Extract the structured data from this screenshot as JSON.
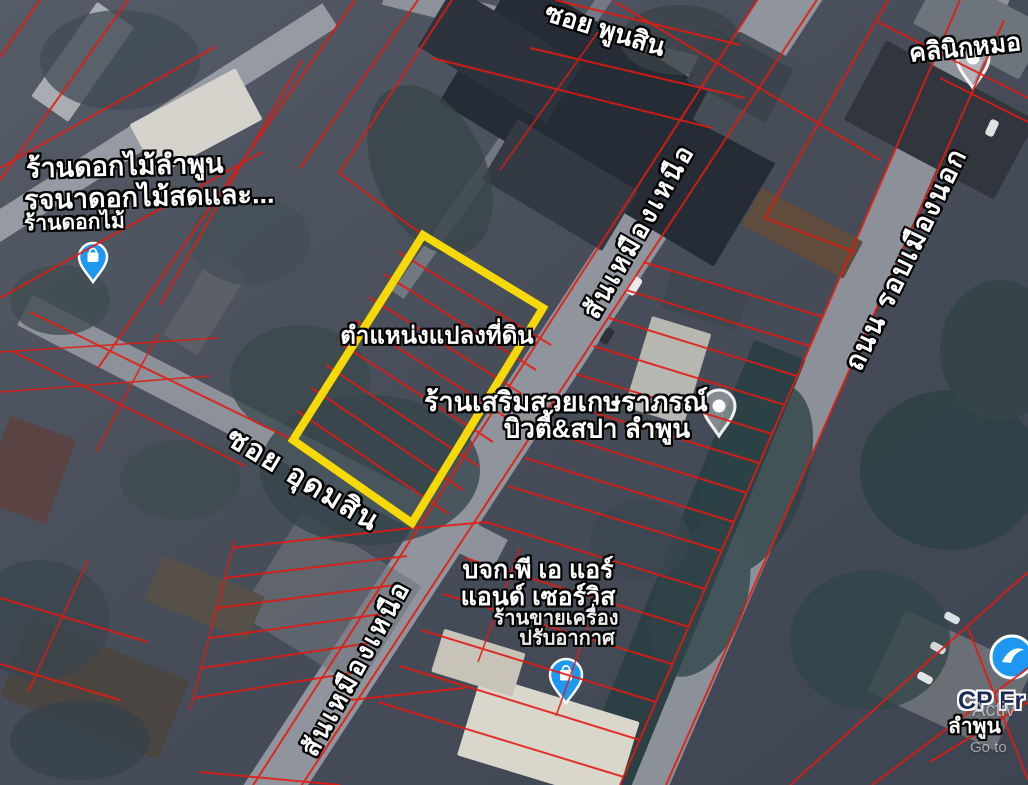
{
  "labels": {
    "soi_phunsin": "ซอย พูนสิน",
    "clinic": "คลินิกหมอ",
    "flower_shop": {
      "line1": "ร้านดอกไม้ลำพูน",
      "line2": "รจนาดอกไม้สดและ...",
      "line3": "ร้านดอกไม้"
    },
    "plot_marker": "ตำแหน่งแปลงที่ดิน",
    "road_san_mueang_nuea_upper": "สันเหมืองเหนือ",
    "road_san_mueang_nuea_lower": "สันเหมืองเหนือ",
    "beauty_salon": {
      "line1": "ร้านเสริมสวยเกษราภรณ์",
      "line2": "บิวตี้&สปา ลำพูน"
    },
    "soi_udomsin": "ซอย อุดมสิน",
    "air_service": {
      "line1": "บจก.พี เอ แอร์",
      "line2": "แอนด์ เซอร์วิส",
      "line3": "ร้านขายเครื่อง",
      "line4": "ปรับอากาศ"
    },
    "road_rob_mueang_nok": "ถนน รอบเมืองนอก",
    "cp_store": {
      "line1": "CP Fr",
      "line2": "ลำพูน"
    },
    "watermark": {
      "line1": "Activ",
      "line2": "Go to"
    }
  },
  "colors": {
    "parcel_line": "#e21b12",
    "plot_highlight": "#ffdf00",
    "poi_pin_blue": "#1e97f3",
    "white_pin": "#ffffff",
    "label_text": "#ffffff"
  },
  "icons": {
    "flower_shop_pin": "shopping-bag-pin",
    "beauty_salon_pin": "white-place-pin",
    "clinic_pin": "white-place-pin",
    "air_service_pin": "shopping-bag-pin",
    "cp_store_pin": "store-pin"
  }
}
